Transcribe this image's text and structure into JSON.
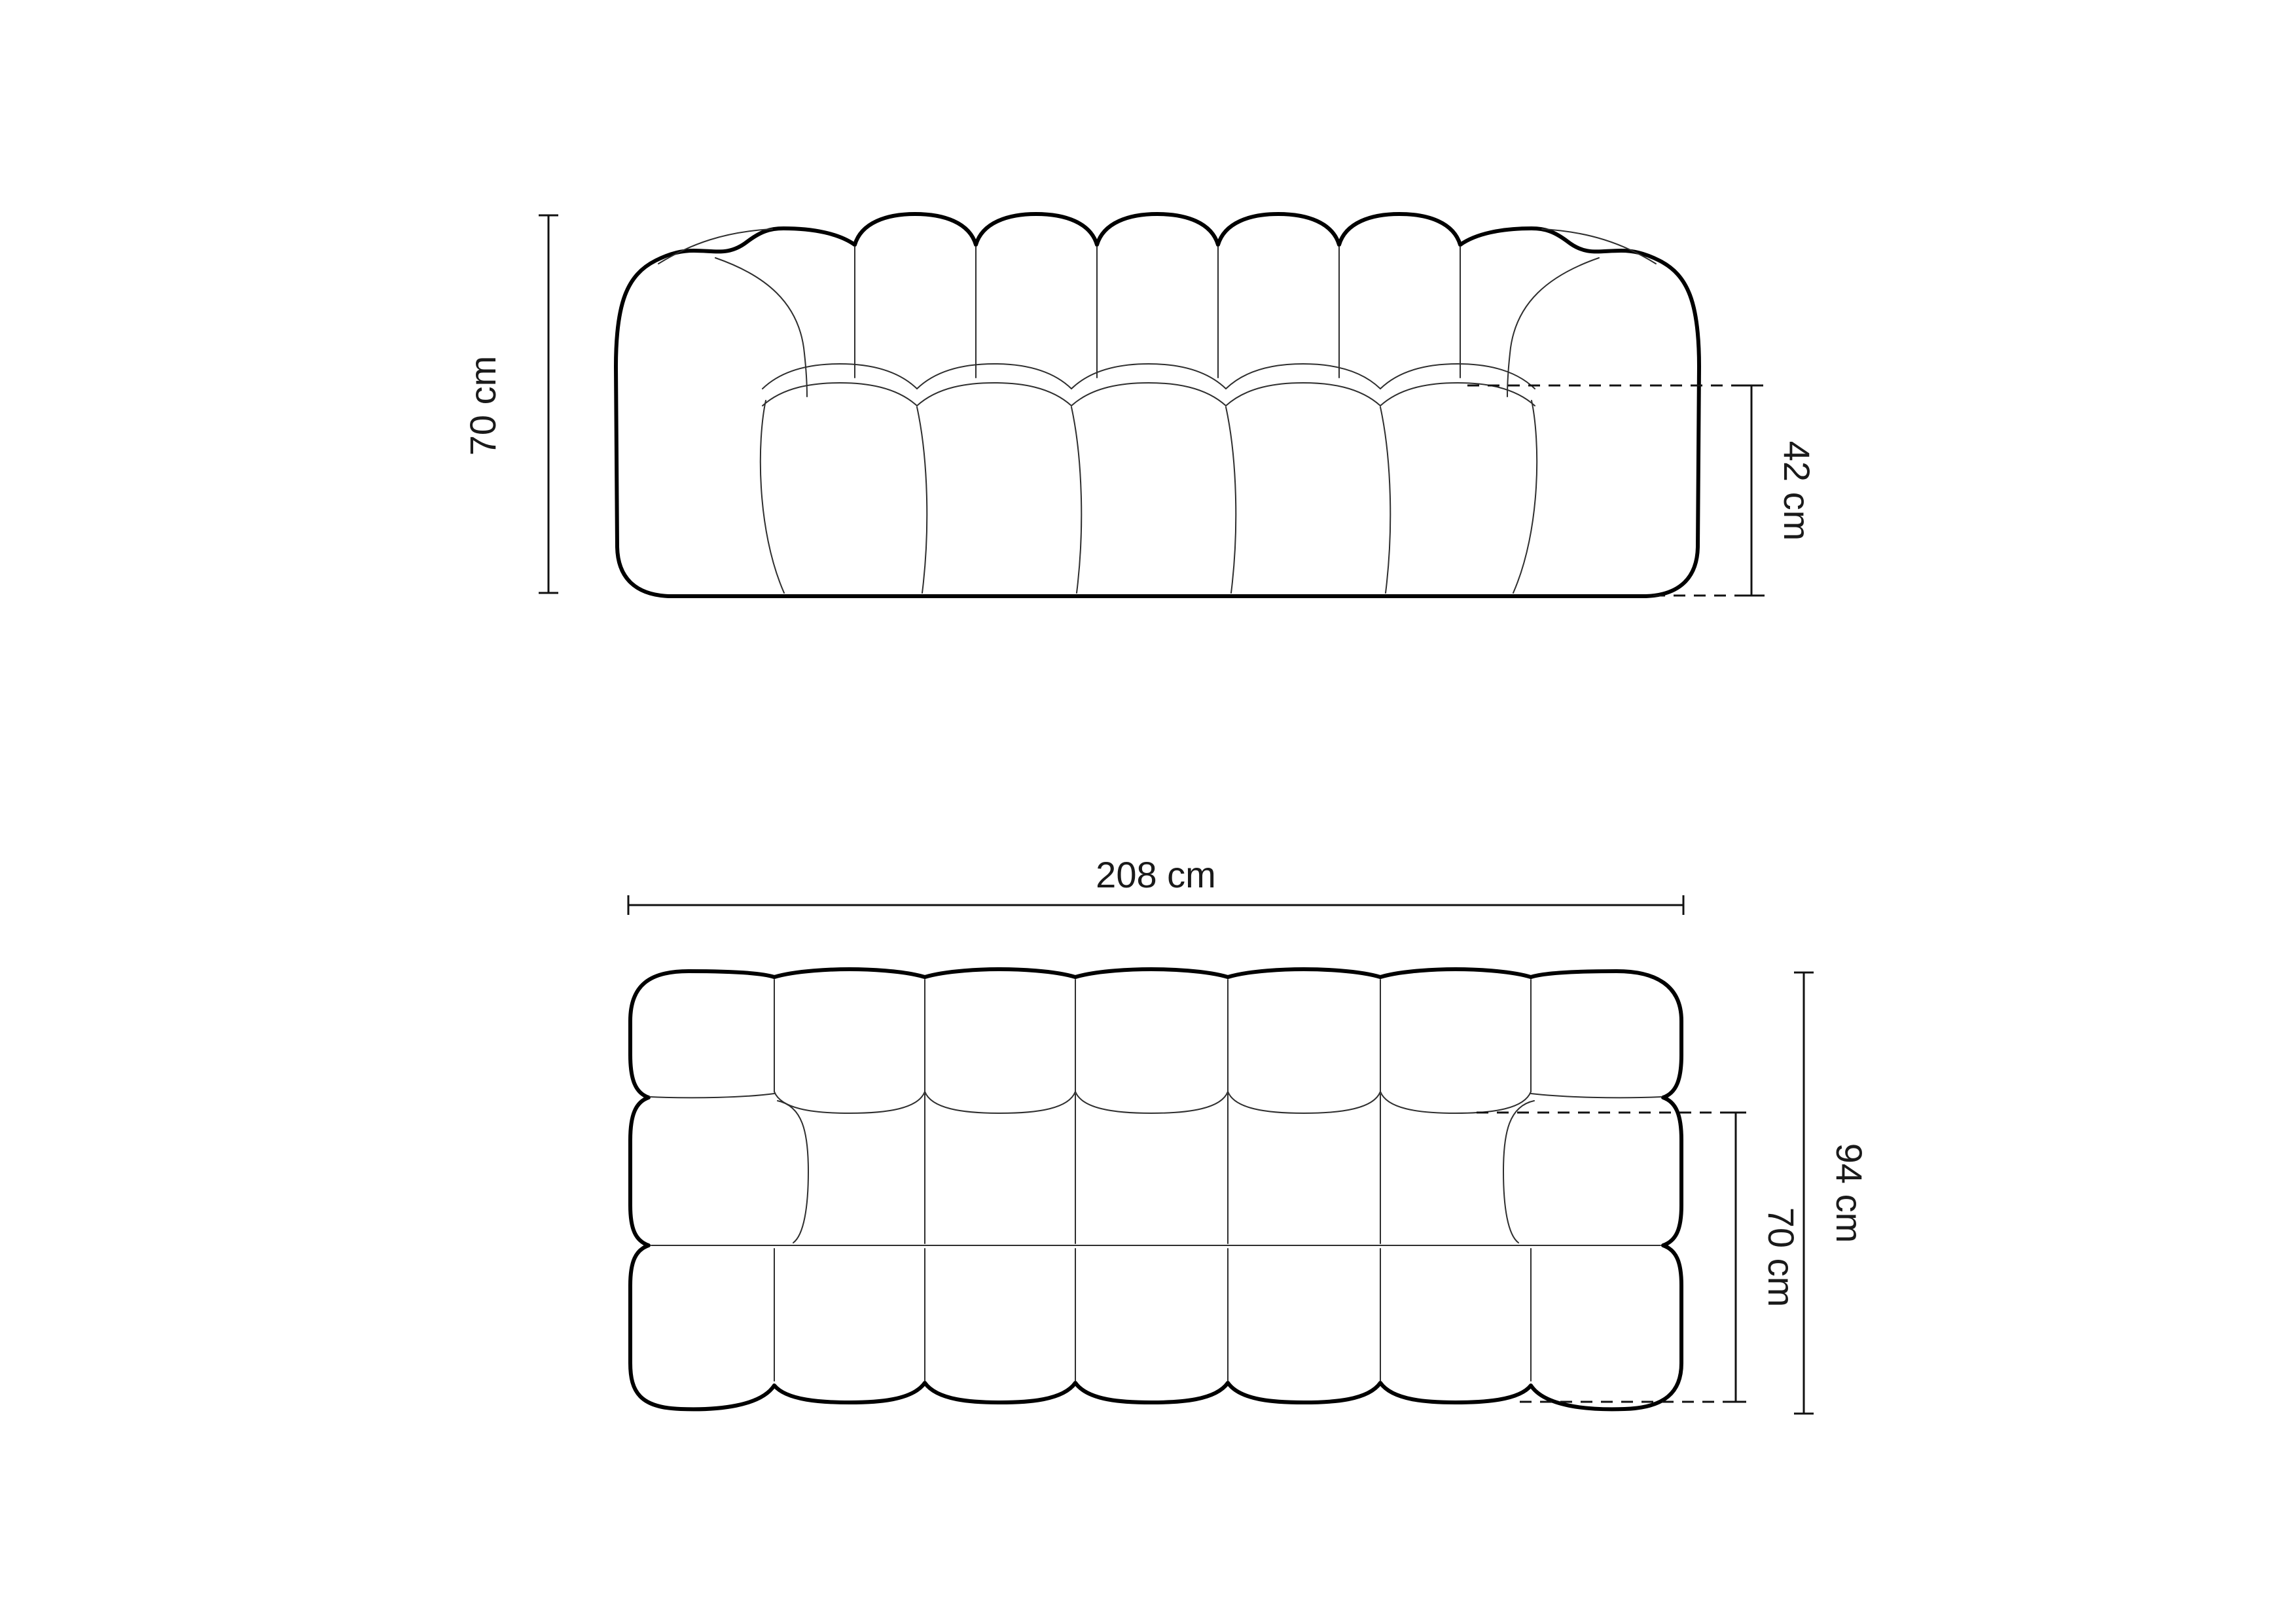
{
  "dimensions": {
    "front": {
      "overall_height": "70 cm",
      "seat_height": "42 cm"
    },
    "top": {
      "overall_width": "208 cm",
      "overall_depth": "94 cm",
      "seat_depth": "70 cm"
    }
  },
  "colors": {
    "background": "#ffffff",
    "outline": "#000000",
    "detail_line": "#2e2e2e",
    "dimension_line": "#111111",
    "label_text": "#1a1a1a"
  }
}
